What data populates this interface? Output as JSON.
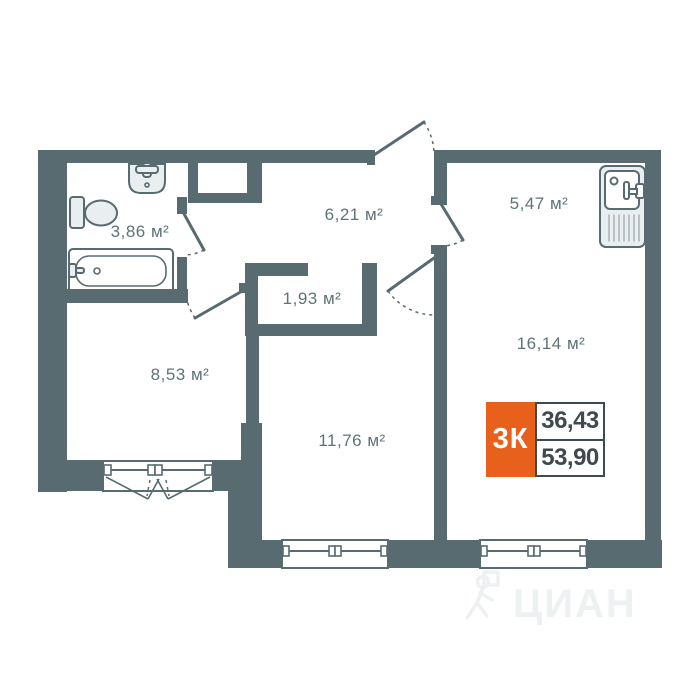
{
  "colors": {
    "wall": "#586b70",
    "fx": "#e9eef0",
    "label": "#5f7377",
    "orange": "#e7611d",
    "dark": "#3e4a4e",
    "wm": "#eef1f2"
  },
  "rooms": [
    {
      "id": "bathroom",
      "label": "3,86 м²"
    },
    {
      "id": "hallway",
      "label": "6,21 м²"
    },
    {
      "id": "kitchen",
      "label": "5,47 м²"
    },
    {
      "id": "closet",
      "label": "1,93 м²"
    },
    {
      "id": "room-left",
      "label": "8,53 м²"
    },
    {
      "id": "room-middle",
      "label": "11,76 м²"
    },
    {
      "id": "room-right",
      "label": "16,14 м²"
    }
  ],
  "badge": {
    "type_label": "3К",
    "top_value": "36,43",
    "bottom_value": "53,90"
  },
  "watermark": {
    "text": "ЦИАН"
  },
  "icons": {
    "bathtub": "svg-shape",
    "toilet": "svg-shape",
    "bath-sink": "svg-shape",
    "kitchen-sink": "svg-shape",
    "window": "svg-shape",
    "door-swing": "svg-arc",
    "watermark-person": "svg-stroke-figure"
  }
}
